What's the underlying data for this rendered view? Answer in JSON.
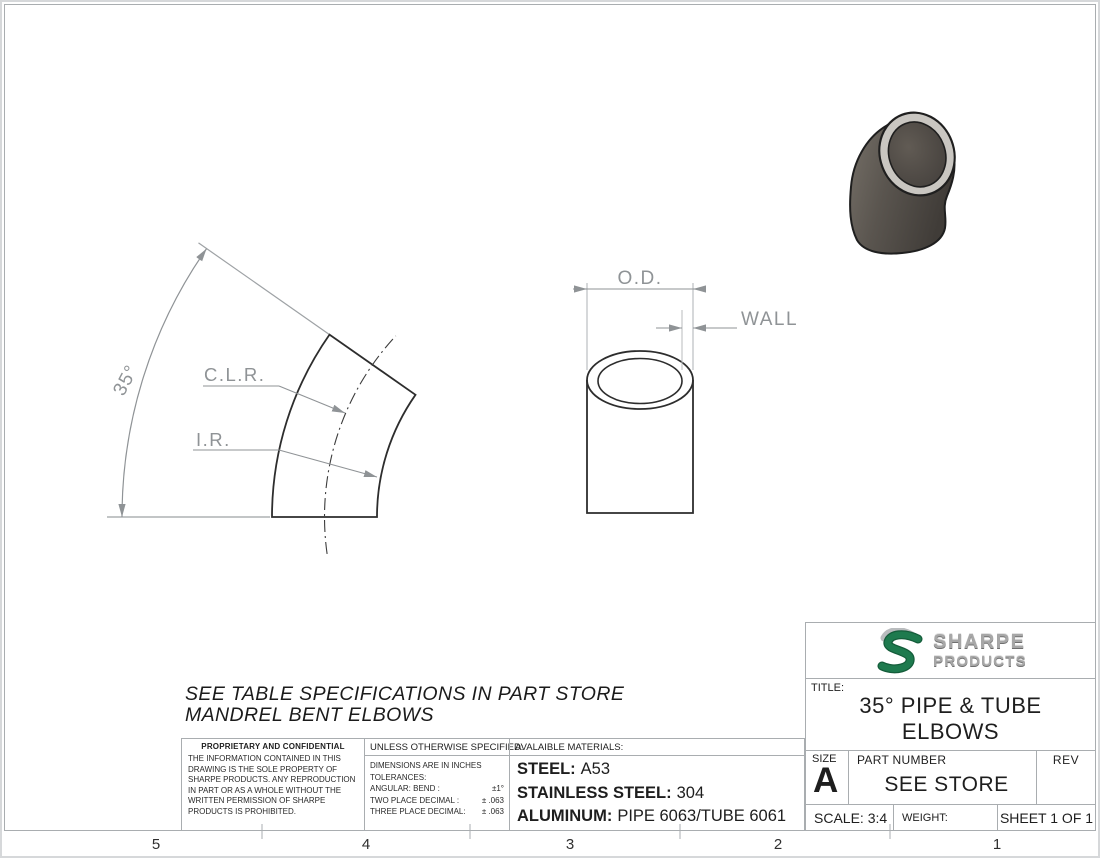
{
  "sheet": {
    "zones": [
      "5",
      "4",
      "3",
      "2",
      "1"
    ],
    "note_line1": "SEE TABLE SPECIFICATIONS IN PART STORE",
    "note_line2": "MANDREL BENT ELBOWS"
  },
  "views": {
    "elbow_profile": {
      "angle_label": "35°",
      "clr_label": "C.L.R.",
      "ir_label": "I.R."
    },
    "tube_end": {
      "od_label": "O.D.",
      "wall_label": "WALL"
    }
  },
  "proprietary": {
    "heading": "PROPRIETARY AND CONFIDENTIAL",
    "body": "THE INFORMATION CONTAINED IN THIS DRAWING IS THE SOLE PROPERTY OF SHARPE PRODUCTS.  ANY REPRODUCTION IN PART OR AS A WHOLE WITHOUT THE WRITTEN PERMISSION OF SHARPE PRODUCTS IS PROHIBITED."
  },
  "tolerances": {
    "heading": "UNLESS OTHERWISE SPECIFIED:",
    "line1": "DIMENSIONS ARE IN INCHES",
    "line2": "TOLERANCES:",
    "rows": [
      {
        "label": "ANGULAR: BEND :",
        "value": "±1°"
      },
      {
        "label": "TWO PLACE DECIMAL :",
        "value": "± .063"
      },
      {
        "label": "THREE PLACE DECIMAL:",
        "value": "± .063"
      }
    ]
  },
  "materials": {
    "heading": "AVALAIBLE MATERIALS:",
    "rows": [
      {
        "label": "STEEL:",
        "value": "A53"
      },
      {
        "label": "STAINLESS STEEL:",
        "value": "304"
      },
      {
        "label": "ALUMINUM:",
        "value": "PIPE 6063/TUBE 6061"
      }
    ]
  },
  "title_block": {
    "brand_line1": "SHARPE",
    "brand_line2": "PRODUCTS",
    "title_label": "TITLE:",
    "title_line1": "35° PIPE & TUBE",
    "title_line2": "ELBOWS",
    "size_label": "SIZE",
    "size_value": "A",
    "part_number_label": "PART NUMBER",
    "part_number_value": "SEE STORE",
    "rev_label": "REV",
    "scale_label": "SCALE: 3:4",
    "weight_label": "WEIGHT:",
    "sheet_label": "SHEET 1 OF 1"
  },
  "colors": {
    "logo_green": "#1e7a4e",
    "dimension_gray": "#8f9396",
    "object_line": "#2d2d2d",
    "metal_ring_light": "#c9c6c1",
    "body_dark": "#3f3b37",
    "border_gray": "#a9adb0"
  }
}
